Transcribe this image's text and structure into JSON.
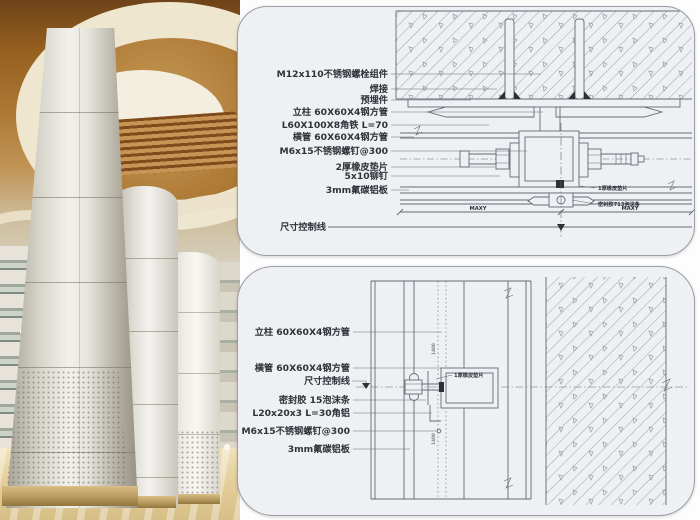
{
  "palette": {
    "panel_bg": "#eef0f3",
    "panel_border": "#9aa0a8",
    "line": "#646a74",
    "text": "#2f3339",
    "wood": "#aa7631",
    "cream": "#efe6d0",
    "column_light": "#f2f1ec",
    "floor": "#e3cd99"
  },
  "top_detail": {
    "labels": [
      {
        "text": "M12x110不锈钢螺栓组件"
      },
      {
        "text": "焊接"
      },
      {
        "text": "预埋件"
      },
      {
        "text": "立柱 60X60X4钢方管"
      },
      {
        "text": "L60X100X8角铁 L=70"
      },
      {
        "text": "横管 60X60X4钢方管"
      },
      {
        "text": "M6x15不锈钢螺钉@300"
      },
      {
        "text": "2厚橡皮垫片"
      },
      {
        "text": "5x10铆钉"
      },
      {
        "text": "3mm氟碳铝板"
      },
      {
        "text": "尺寸控制线"
      }
    ],
    "callouts": [
      {
        "text": "1厚橡皮垫片"
      },
      {
        "text": "密封胶713泡沫条"
      }
    ],
    "dim_label": "MAXY"
  },
  "bottom_detail": {
    "labels": [
      {
        "text": "立柱 60X60X4钢方管"
      },
      {
        "text": "横管 60X60X4钢方管"
      },
      {
        "text": "尺寸控制线"
      },
      {
        "text": "密封胶 15泡沫条"
      },
      {
        "text": "L20x20x3 L=30角铝"
      },
      {
        "text": "M6x15不锈钢螺钉@300"
      },
      {
        "text": "3mm氟碳铝板"
      }
    ],
    "callout": "1厚橡皮垫片",
    "dim_vertical": "1400"
  }
}
